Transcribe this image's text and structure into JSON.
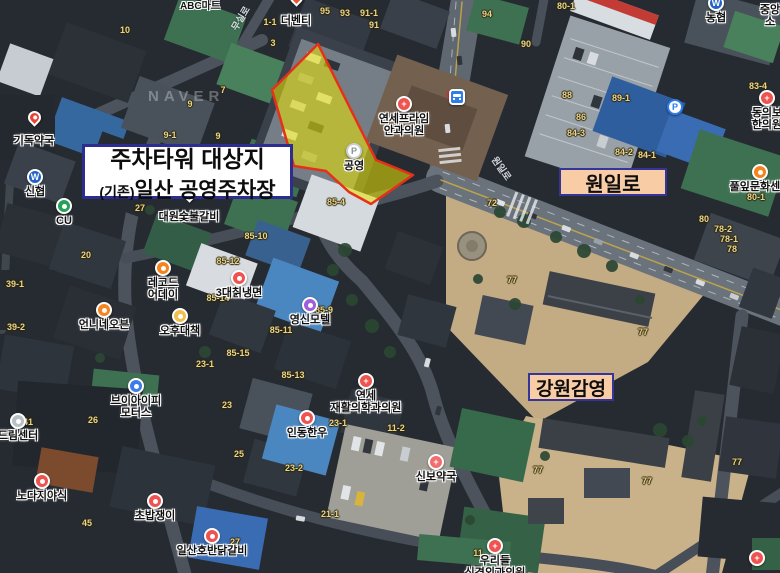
{
  "watermark": "NAVER",
  "annotations": {
    "site": {
      "line1": "주차타워 대상지",
      "line2_prefix": "(기존)",
      "line2_main": "일산 공영주차장"
    },
    "road": {
      "label": "원일로"
    },
    "landmark": {
      "label": "강원감영"
    }
  },
  "colors": {
    "highlight_fill": "#ebe400",
    "highlight_border": "#e63119",
    "annotation_border_navy": "#2c2c91",
    "annotation_peach_bg": "#f8cda6",
    "poi_red": "#ee5350",
    "poi_orange": "#f5841f",
    "bank_blue": "#2263c8",
    "bus_blue": "#2e7de9"
  },
  "pois": [
    {
      "id": "gidok-pharmacy",
      "lines": [
        "기독약국"
      ],
      "icon": {
        "type": "marker",
        "color": "#e84330"
      },
      "x": 34,
      "y": 126
    },
    {
      "id": "sinhyup-bank",
      "lines": [
        "신협"
      ],
      "icon": {
        "type": "circle",
        "color": "#2263c8",
        "glyph": "W"
      },
      "x": 35,
      "y": 177
    },
    {
      "id": "cu-store",
      "lines": [
        "CU"
      ],
      "icon": {
        "type": "circle",
        "color": "#27a05a",
        "glyph": ""
      },
      "x": 64,
      "y": 206
    },
    {
      "id": "the-venti",
      "lines": [
        "더벤티"
      ],
      "icon": {
        "type": "marker",
        "color": "#e8552e"
      },
      "x": 296,
      "y": 6
    },
    {
      "id": "daewon-charcoal-ribs",
      "lines": [
        "대원숯불갈비"
      ],
      "icon": {
        "type": "marker",
        "color": "#f07a28"
      },
      "x": 189,
      "y": 202
    },
    {
      "id": "yonsei-prime-eye-clinic",
      "lines": [
        "연세프라임",
        "안과의원"
      ],
      "icon": {
        "type": "circle",
        "color": "#ee5350",
        "glyph": "+"
      },
      "x": 404,
      "y": 104
    },
    {
      "id": "record-aday",
      "lines": [
        "레코드",
        "어데이"
      ],
      "icon": {
        "type": "circle",
        "color": "#f5841f",
        "glyph": ""
      },
      "x": 163,
      "y": 268
    },
    {
      "id": "3dae-chik-naengmyeon",
      "lines": [
        "3대칡냉면"
      ],
      "icon": {
        "type": "circle",
        "color": "#ee5350",
        "glyph": ""
      },
      "x": 239,
      "y": 278
    },
    {
      "id": "unnine-oven",
      "lines": [
        "언니네오븐"
      ],
      "icon": {
        "type": "circle",
        "color": "#f5841f",
        "glyph": ""
      },
      "x": 104,
      "y": 310
    },
    {
      "id": "ohu-daechaek",
      "lines": [
        "오후대책"
      ],
      "icon": {
        "type": "circle",
        "color": "#f0bf4e",
        "glyph": ""
      },
      "x": 180,
      "y": 316
    },
    {
      "id": "yeongsin-motel",
      "lines": [
        "영신모텔"
      ],
      "icon": {
        "type": "circle",
        "color": "#a05fd6",
        "glyph": ""
      },
      "x": 310,
      "y": 305
    },
    {
      "id": "yonsei-rehab-clinic",
      "lines": [
        "연세",
        "재활의학과의원"
      ],
      "icon": {
        "type": "circle",
        "color": "#ee5350",
        "glyph": "+"
      },
      "x": 366,
      "y": 381
    },
    {
      "id": "indong-hanwoo",
      "lines": [
        "인동한우"
      ],
      "icon": {
        "type": "circle",
        "color": "#ee5350",
        "glyph": ""
      },
      "x": 307,
      "y": 418
    },
    {
      "id": "sinbo-pharmacy",
      "lines": [
        "신보약국"
      ],
      "icon": {
        "type": "circle",
        "color": "#f26d6d",
        "glyph": "+"
      },
      "x": 436,
      "y": 462
    },
    {
      "id": "urideul-clinic",
      "lines": [
        "우리들",
        "신경외과의원"
      ],
      "icon": {
        "type": "circle",
        "color": "#ee5350",
        "glyph": "+"
      },
      "x": 495,
      "y": 546
    },
    {
      "id": "dream-center",
      "lines": [
        "드림센터"
      ],
      "icon": {
        "type": "circle",
        "color": "#b8c0c8",
        "glyph": ""
      },
      "x": 18,
      "y": 421
    },
    {
      "id": "nodaji-yasik",
      "lines": [
        "노다지야식"
      ],
      "icon": {
        "type": "circle",
        "color": "#ee5350",
        "glyph": ""
      },
      "x": 42,
      "y": 481
    },
    {
      "id": "vip-motors",
      "lines": [
        "브이아이피",
        "모터스"
      ],
      "icon": {
        "type": "circle",
        "color": "#3d7ce8",
        "glyph": ""
      },
      "x": 136,
      "y": 386
    },
    {
      "id": "chobap-jaengi",
      "lines": [
        "초밥쟁이"
      ],
      "icon": {
        "type": "circle",
        "color": "#ee5350",
        "glyph": ""
      },
      "x": 155,
      "y": 501
    },
    {
      "id": "ilsan-hoban-dakgalbi",
      "lines": [
        "일산호반닭갈비"
      ],
      "icon": {
        "type": "circle",
        "color": "#ee5350",
        "glyph": ""
      },
      "x": 212,
      "y": 536
    },
    {
      "id": "nonghyup-bank",
      "lines": [
        "농협"
      ],
      "icon": {
        "type": "circle",
        "color": "#2263c8",
        "glyph": "W"
      },
      "x": 716,
      "y": 3
    },
    {
      "id": "donguibogam-clinic",
      "lines": [
        "동의보",
        "한의원"
      ],
      "icon": {
        "type": "circle",
        "color": "#ee5350",
        "glyph": "+"
      },
      "x": 767,
      "y": 98
    },
    {
      "id": "pullip-culture-center",
      "lines": [
        "풀잎문화센터"
      ],
      "icon": {
        "type": "circle",
        "color": "#f5841f",
        "glyph": ""
      },
      "x": 760,
      "y": 172
    },
    {
      "id": "jungang-partial",
      "lines": [
        "중앙",
        "소"
      ],
      "icon": {
        "type": "none"
      },
      "x": 770,
      "y": 2
    },
    {
      "id": "hospital-bottom-right",
      "lines": [],
      "icon": {
        "type": "circle",
        "color": "#ee5350",
        "glyph": "+"
      },
      "x": 757,
      "y": 558
    },
    {
      "id": "bus-stop",
      "lines": [],
      "icon": {
        "type": "bus",
        "color": "#2e7de9"
      },
      "x": 457,
      "y": 97
    },
    {
      "id": "public-parking",
      "lines": [
        "공영"
      ],
      "icon": {
        "type": "circle",
        "color": "#ffffff",
        "glyph": "P",
        "glyphColor": "#8a9099",
        "ring": "#c9ced4"
      },
      "x": 354,
      "y": 151
    },
    {
      "id": "parking-p",
      "lines": [],
      "icon": {
        "type": "circle",
        "color": "#ffffff",
        "glyph": "P",
        "glyphColor": "#2e7de9",
        "ring": "#2e7de9"
      },
      "x": 675,
      "y": 107
    }
  ],
  "lot_numbers": [
    {
      "t": "10",
      "x": 125,
      "y": 30
    },
    {
      "t": "1-1",
      "x": 270,
      "y": 22
    },
    {
      "t": "3",
      "x": 273,
      "y": 43
    },
    {
      "t": "95",
      "x": 325,
      "y": 11
    },
    {
      "t": "93",
      "x": 345,
      "y": 13
    },
    {
      "t": "91-1",
      "x": 369,
      "y": 13
    },
    {
      "t": "91",
      "x": 374,
      "y": 25
    },
    {
      "t": "94",
      "x": 487,
      "y": 14
    },
    {
      "t": "90",
      "x": 526,
      "y": 44
    },
    {
      "t": "80-1",
      "x": 566,
      "y": 6
    },
    {
      "t": "88",
      "x": 567,
      "y": 95
    },
    {
      "t": "89-1",
      "x": 621,
      "y": 98
    },
    {
      "t": "86",
      "x": 581,
      "y": 117
    },
    {
      "t": "84-3",
      "x": 576,
      "y": 133
    },
    {
      "t": "84-2",
      "x": 624,
      "y": 152
    },
    {
      "t": "84-1",
      "x": 647,
      "y": 155
    },
    {
      "t": "83-4",
      "x": 758,
      "y": 86
    },
    {
      "t": "80-1",
      "x": 756,
      "y": 197
    },
    {
      "t": "80",
      "x": 704,
      "y": 219
    },
    {
      "t": "78-2",
      "x": 723,
      "y": 229
    },
    {
      "t": "78-1",
      "x": 729,
      "y": 239
    },
    {
      "t": "78",
      "x": 732,
      "y": 249
    },
    {
      "t": "72",
      "x": 492,
      "y": 203
    },
    {
      "t": "77",
      "x": 512,
      "y": 280
    },
    {
      "t": "77",
      "x": 643,
      "y": 332
    },
    {
      "t": "77",
      "x": 538,
      "y": 470
    },
    {
      "t": "77",
      "x": 647,
      "y": 481
    },
    {
      "t": "77",
      "x": 737,
      "y": 462
    },
    {
      "t": "85-10",
      "x": 256,
      "y": 236
    },
    {
      "t": "85-12",
      "x": 228,
      "y": 261
    },
    {
      "t": "85-14",
      "x": 218,
      "y": 298
    },
    {
      "t": "85-15",
      "x": 238,
      "y": 353
    },
    {
      "t": "23-1",
      "x": 205,
      "y": 364
    },
    {
      "t": "85-11",
      "x": 281,
      "y": 330
    },
    {
      "t": "85-9",
      "x": 324,
      "y": 310
    },
    {
      "t": "85-13",
      "x": 293,
      "y": 375
    },
    {
      "t": "85-4",
      "x": 336,
      "y": 202
    },
    {
      "t": "23-1",
      "x": 338,
      "y": 423
    },
    {
      "t": "11-2",
      "x": 396,
      "y": 428
    },
    {
      "t": "23-2",
      "x": 294,
      "y": 468
    },
    {
      "t": "21-1",
      "x": 330,
      "y": 514
    },
    {
      "t": "11",
      "x": 478,
      "y": 553
    },
    {
      "t": "26",
      "x": 93,
      "y": 420
    },
    {
      "t": "23",
      "x": 227,
      "y": 405
    },
    {
      "t": "25",
      "x": 239,
      "y": 454
    },
    {
      "t": "41",
      "x": 28,
      "y": 422
    },
    {
      "t": "45",
      "x": 87,
      "y": 523
    },
    {
      "t": "27",
      "x": 235,
      "y": 542
    },
    {
      "t": "39-1",
      "x": 15,
      "y": 284
    },
    {
      "t": "39-2",
      "x": 16,
      "y": 327
    },
    {
      "t": "20",
      "x": 86,
      "y": 255
    },
    {
      "t": "27",
      "x": 140,
      "y": 208
    },
    {
      "t": "7",
      "x": 223,
      "y": 90
    },
    {
      "t": "9",
      "x": 190,
      "y": 104
    },
    {
      "t": "9-1",
      "x": 170,
      "y": 135
    },
    {
      "t": "9",
      "x": 218,
      "y": 136
    }
  ],
  "road_names": [
    {
      "t": "원일로",
      "x": 502,
      "y": 168,
      "rot": 55
    },
    {
      "t": "무실로",
      "x": 240,
      "y": 18,
      "rot": -59
    }
  ],
  "map_texts": [
    {
      "t": "ABC마트",
      "x": 200,
      "y": -3
    }
  ]
}
